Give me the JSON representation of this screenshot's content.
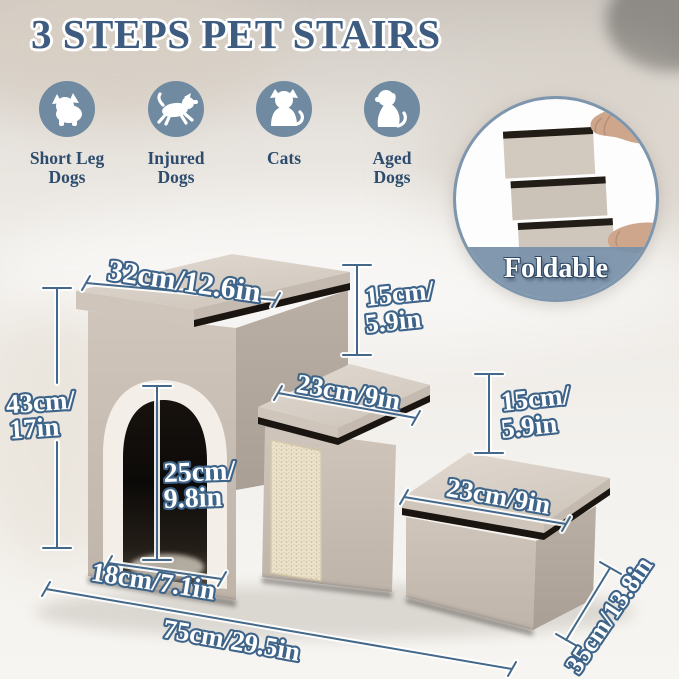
{
  "title": "3 STEPS PET STAIRS",
  "audience": {
    "items": [
      {
        "icon": "short-leg-dog-icon",
        "line1": "Short Leg",
        "line2": "Dogs"
      },
      {
        "icon": "injured-dog-icon",
        "line1": "Injured",
        "line2": "Dogs"
      },
      {
        "icon": "cat-icon",
        "line1": "Cats",
        "line2": ""
      },
      {
        "icon": "aged-dog-icon",
        "line1": "Aged",
        "line2": "Dogs"
      }
    ]
  },
  "foldable": {
    "label": "Foldable"
  },
  "dimensions": {
    "lid_width": "32cm/12.6in",
    "step1_rise": {
      "line1": "15cm/",
      "line2": "5.9in"
    },
    "step2_tread": "23cm/9in",
    "step2_rise": {
      "line1": "15cm/",
      "line2": "5.9in"
    },
    "step3_tread": "23cm/9in",
    "house_height": {
      "line1": "43cm/",
      "line2": "17in"
    },
    "door_height": {
      "line1": "25cm/",
      "line2": "9.8in"
    },
    "door_width": "18cm/7.1in",
    "base_length": "75cm/29.5in",
    "base_depth": "35cm/13.8in"
  },
  "colors": {
    "title_text": "#3d5c80",
    "icon_circle": "#6f8aa1",
    "icon_label": "#2e4d6e",
    "dimension_line": "#43688a",
    "dimension_text_fill": "#ffffff",
    "dimension_text_outline": "#3e6489",
    "fabric_light": "#ddd5cc",
    "fabric_mid": "#c8beb4",
    "fabric_dark": "#b5aca2",
    "trim_black": "#1a1510",
    "sherpa_white": "#f3efe8",
    "scratch_pad": "#ece2cc",
    "badge_band": "#7a92aa"
  }
}
